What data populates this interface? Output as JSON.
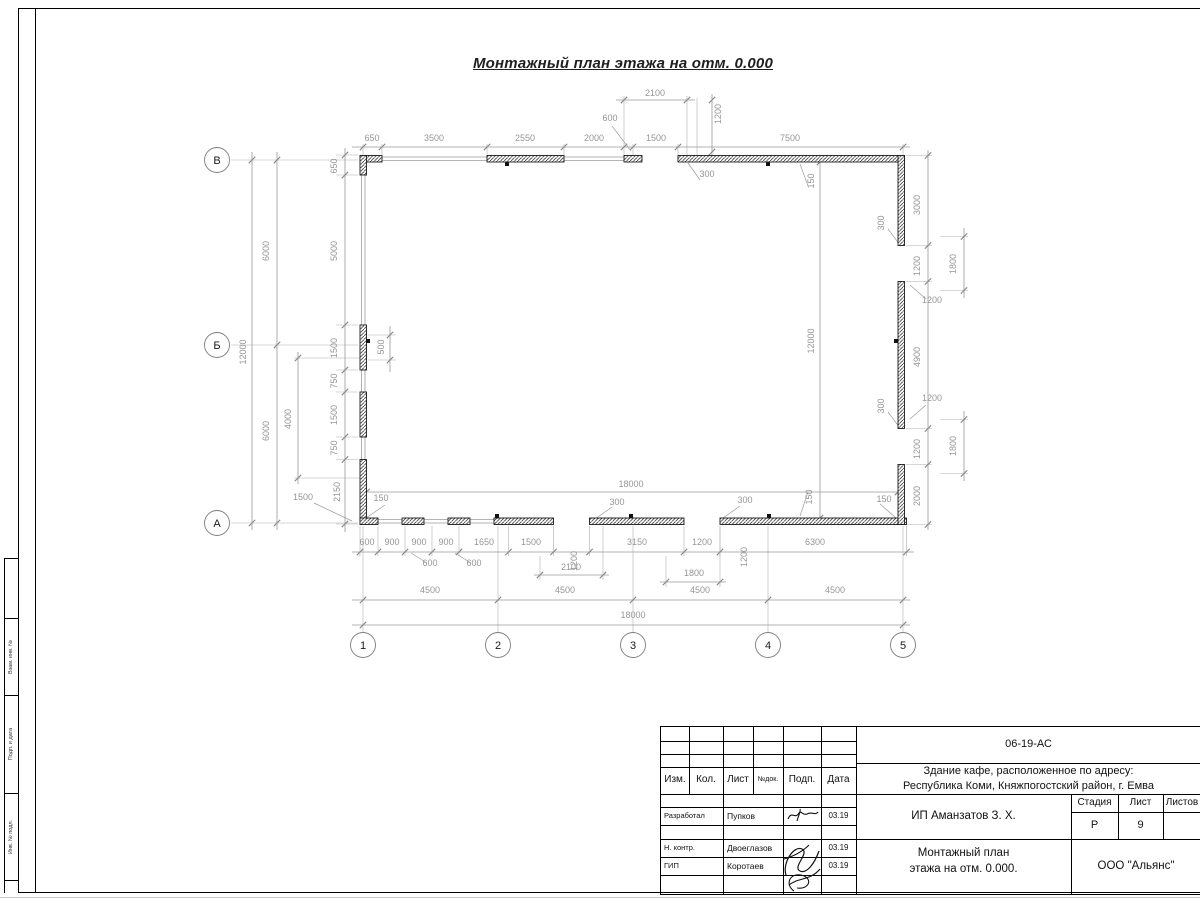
{
  "sheet": {
    "title": "Монтажный план этажа на отм. 0.000"
  },
  "plan": {
    "axis_bubbles_left": [
      "В",
      "Б",
      "А"
    ],
    "axis_bubbles_bottom": [
      "1",
      "2",
      "3",
      "4",
      "5"
    ],
    "dimensions": [
      {
        "t": "650",
        "x": 372,
        "y": 141
      },
      {
        "t": "3500",
        "x": 434,
        "y": 141
      },
      {
        "t": "2550",
        "x": 525,
        "y": 141
      },
      {
        "t": "2000",
        "x": 594,
        "y": 141
      },
      {
        "t": "1500",
        "x": 656,
        "y": 141
      },
      {
        "t": "7500",
        "x": 790,
        "y": 141
      },
      {
        "t": "2100",
        "x": 655,
        "y": 96
      },
      {
        "t": "600",
        "x": 610,
        "y": 121
      },
      {
        "t": "1200",
        "x": 721,
        "y": 114,
        "r": 1
      },
      {
        "t": "300",
        "x": 707,
        "y": 177
      },
      {
        "t": "150",
        "x": 814,
        "y": 181,
        "r": 1
      },
      {
        "t": "6000",
        "x": 269,
        "y": 251,
        "r": 1
      },
      {
        "t": "6000",
        "x": 269,
        "y": 431,
        "r": 1
      },
      {
        "t": "12000",
        "x": 246,
        "y": 352,
        "r": 1
      },
      {
        "t": "650",
        "x": 337,
        "y": 166,
        "r": 1
      },
      {
        "t": "5000",
        "x": 337,
        "y": 251,
        "r": 1
      },
      {
        "t": "1500",
        "x": 337,
        "y": 348,
        "r": 1
      },
      {
        "t": "750",
        "x": 337,
        "y": 381,
        "r": 1
      },
      {
        "t": "1500",
        "x": 337,
        "y": 415,
        "r": 1
      },
      {
        "t": "750",
        "x": 337,
        "y": 448,
        "r": 1
      },
      {
        "t": "2150",
        "x": 340,
        "y": 492,
        "r": 1
      },
      {
        "t": "4000",
        "x": 291,
        "y": 419,
        "r": 1
      },
      {
        "t": "500",
        "x": 384,
        "y": 347,
        "r": 1
      },
      {
        "t": "1500",
        "x": 303,
        "y": 500
      },
      {
        "t": "150",
        "x": 381,
        "y": 501
      },
      {
        "t": "600",
        "x": 367,
        "y": 545
      },
      {
        "t": "900",
        "x": 392,
        "y": 545
      },
      {
        "t": "900",
        "x": 419,
        "y": 545
      },
      {
        "t": "900",
        "x": 446,
        "y": 545
      },
      {
        "t": "1650",
        "x": 484,
        "y": 545
      },
      {
        "t": "1500",
        "x": 531,
        "y": 545
      },
      {
        "t": "1200",
        "x": 577,
        "y": 561,
        "r": 1
      },
      {
        "t": "3150",
        "x": 637,
        "y": 545
      },
      {
        "t": "1200",
        "x": 702,
        "y": 545
      },
      {
        "t": "6300",
        "x": 815,
        "y": 545
      },
      {
        "t": "600",
        "x": 430,
        "y": 566
      },
      {
        "t": "600",
        "x": 474,
        "y": 566
      },
      {
        "t": "2100",
        "x": 571,
        "y": 570
      },
      {
        "t": "1800",
        "x": 694,
        "y": 576
      },
      {
        "t": "1200",
        "x": 747,
        "y": 557,
        "r": 1
      },
      {
        "t": "300",
        "x": 617,
        "y": 505
      },
      {
        "t": "300",
        "x": 745,
        "y": 503
      },
      {
        "t": "4500",
        "x": 430,
        "y": 593
      },
      {
        "t": "4500",
        "x": 565,
        "y": 593
      },
      {
        "t": "4500",
        "x": 700,
        "y": 593
      },
      {
        "t": "4500",
        "x": 835,
        "y": 593
      },
      {
        "t": "18000",
        "x": 633,
        "y": 618
      },
      {
        "t": "18000",
        "x": 631,
        "y": 487
      },
      {
        "t": "12000",
        "x": 814,
        "y": 341,
        "r": 1
      },
      {
        "t": "150",
        "x": 812,
        "y": 497,
        "r": 1
      },
      {
        "t": "3000",
        "x": 920,
        "y": 205,
        "r": 1
      },
      {
        "t": "1200",
        "x": 920,
        "y": 266,
        "r": 1
      },
      {
        "t": "4900",
        "x": 920,
        "y": 357,
        "r": 1
      },
      {
        "t": "1200",
        "x": 920,
        "y": 449,
        "r": 1
      },
      {
        "t": "2000",
        "x": 920,
        "y": 496,
        "r": 1
      },
      {
        "t": "1800",
        "x": 956,
        "y": 264,
        "r": 1
      },
      {
        "t": "1800",
        "x": 956,
        "y": 446,
        "r": 1
      },
      {
        "t": "300",
        "x": 884,
        "y": 223,
        "r": 1
      },
      {
        "t": "300",
        "x": 884,
        "y": 406,
        "r": 1
      },
      {
        "t": "1200",
        "x": 932,
        "y": 303
      },
      {
        "t": "1200",
        "x": 932,
        "y": 401
      },
      {
        "t": "150",
        "x": 884,
        "y": 502
      }
    ]
  },
  "side_stamp": {
    "cells": [
      "Взам. инв. №",
      "Подп. и дата",
      "Инв. № подл."
    ]
  },
  "title_block": {
    "doc_number": "06-19-АС",
    "project_line1": "Здание кафе, расположенное по адресу:",
    "project_line2": "Республика Коми, Княжпогостский район, г. Емва",
    "client": "ИП Аманзатов З. Х.",
    "sheet_name_line1": "Монтажный план",
    "sheet_name_line2": "этажа на отм. 0.000.",
    "company": "ООО \"Альянс\"",
    "cols": {
      "izm": "Изм.",
      "kol": "Кол.",
      "list": "Лист",
      "ndok": "№док.",
      "podp": "Подп.",
      "data": "Дата"
    },
    "stage_label": "Стадия",
    "sheet_label": "Лист",
    "sheets_label": "Листов",
    "stage_value": "Р",
    "sheet_value": "9",
    "sheets_value": "",
    "rows": [
      {
        "role": "Разработал",
        "name": "Пупков",
        "date": "03.19"
      },
      {
        "role": "Н. контр.",
        "name": "Двоеглазов",
        "date": "03.19"
      },
      {
        "role": "ГИП",
        "name": "Коротаев",
        "date": "03.19"
      }
    ]
  }
}
